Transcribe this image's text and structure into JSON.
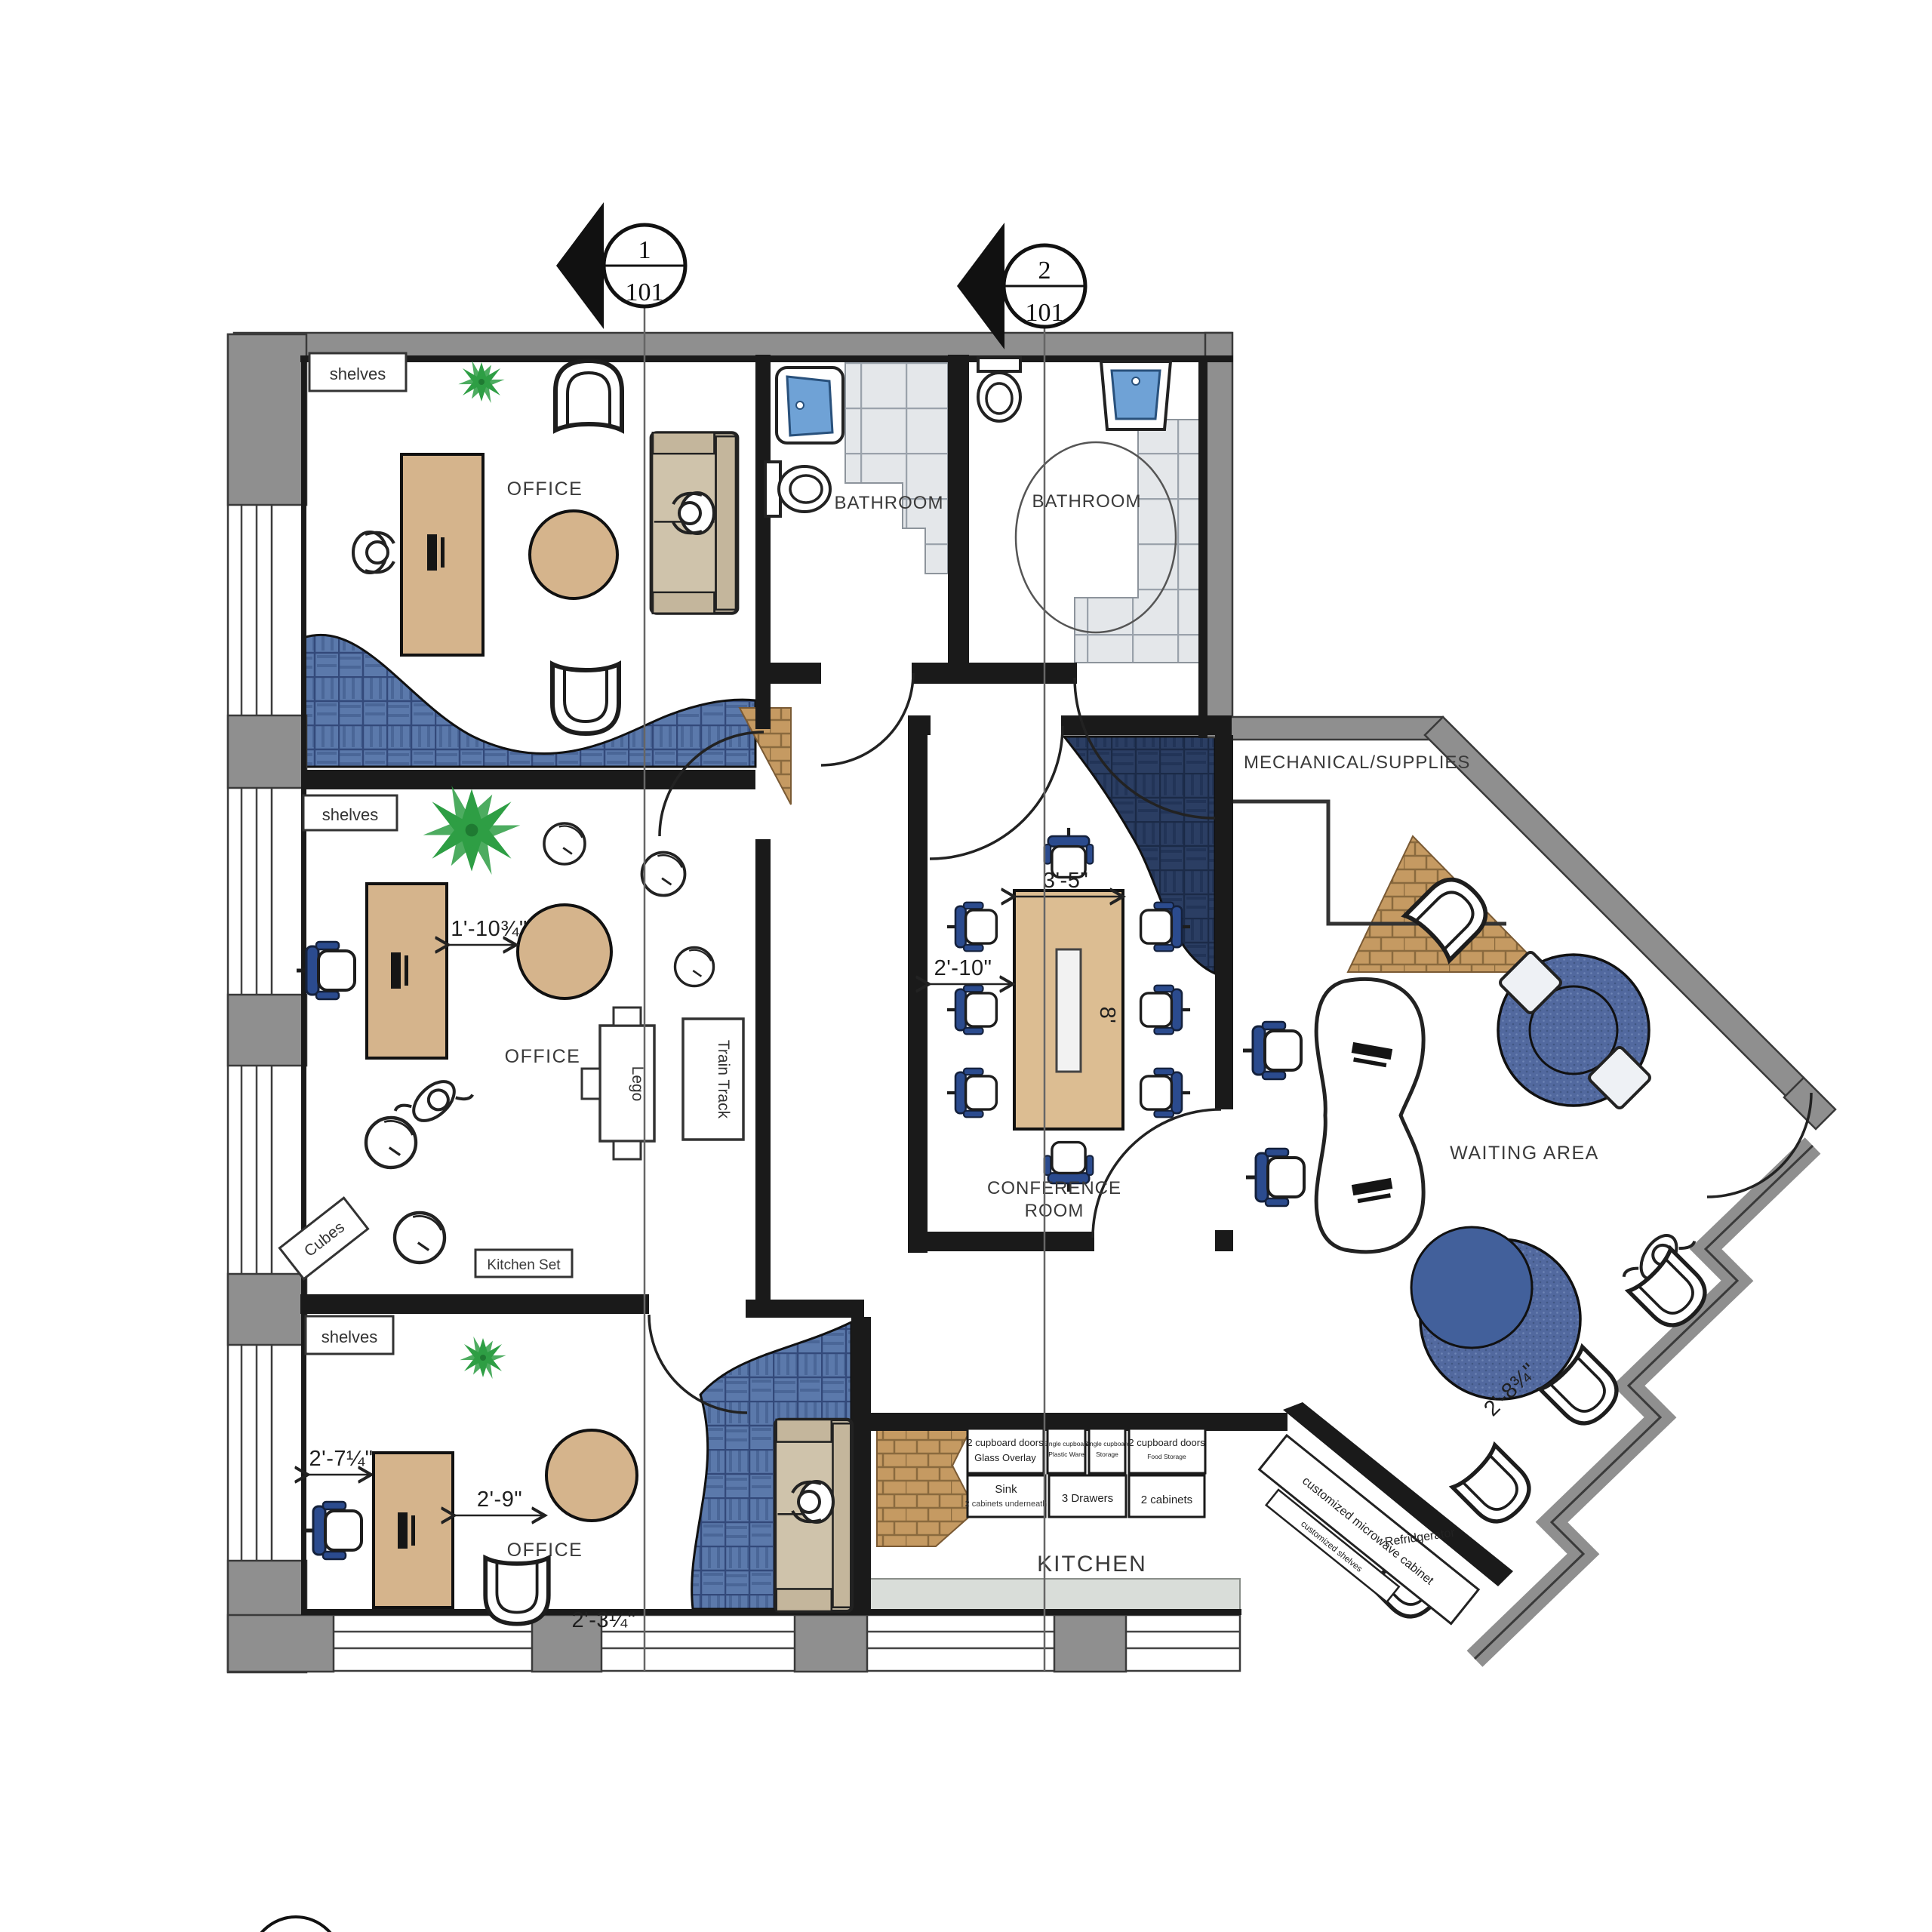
{
  "markers": {
    "m1": {
      "number": "1",
      "sheet": "101"
    },
    "m2": {
      "number": "2",
      "sheet": "101"
    }
  },
  "rooms": {
    "office": "OFFICE",
    "bathroom": "BATHROOM",
    "conference_line1": "CONFERENCE",
    "conference_line2": "ROOM",
    "waiting": "WAITING AREA",
    "kitchen": "KITCHEN",
    "mechanical": "MECHANICAL/SUPPLIES"
  },
  "fixtures": {
    "shelves": "shelves",
    "train_track": "Train Track",
    "lego": "Lego",
    "cubes": "Cubes",
    "kitchen_set": "Kitchen Set",
    "microwave": "customized microwave cabinet",
    "custom_shelves": "customized shelves",
    "refrigerator": "Refridgerator"
  },
  "cabinets": {
    "c1a": "2 cupboard doors",
    "c1b": "Glass Overlay",
    "c2a": "Single cupboard",
    "c2b": "Plastic Ware",
    "c3a": "Single cupboard",
    "c3b": "Storage",
    "c4a": "2 cupboard doors",
    "c4b": "Food Storage",
    "c5a": "Sink",
    "c5b": "2 cabinets underneath",
    "c6": "3 Drawers",
    "c7": "2 cabinets"
  },
  "dimensions": {
    "office2_table": "1'-10¾\"",
    "office3_wall": "2'-7¼\"",
    "office3_table": "2'-9\"",
    "office3_chair": "2'-3¼\"",
    "conf_width": "3'-5\"",
    "conf_wall": "2'-10\"",
    "conf_length": "8'",
    "waiting_chairs": "2'-8¾\""
  },
  "colors": {
    "wall_gray": "#8f8f8f",
    "wall_black": "#1a1a1a",
    "wood": "#d5b48c",
    "navy_carpet": "#2b3e63",
    "steel_rug": "#5b79ab",
    "round_rug": "#52699f",
    "brick": "#c59a62",
    "chair_blue": "#2b4b8e",
    "sink_blue": "#6fa2d6",
    "tile": "#e4e7ea",
    "plant_green": "#2e9e44"
  }
}
